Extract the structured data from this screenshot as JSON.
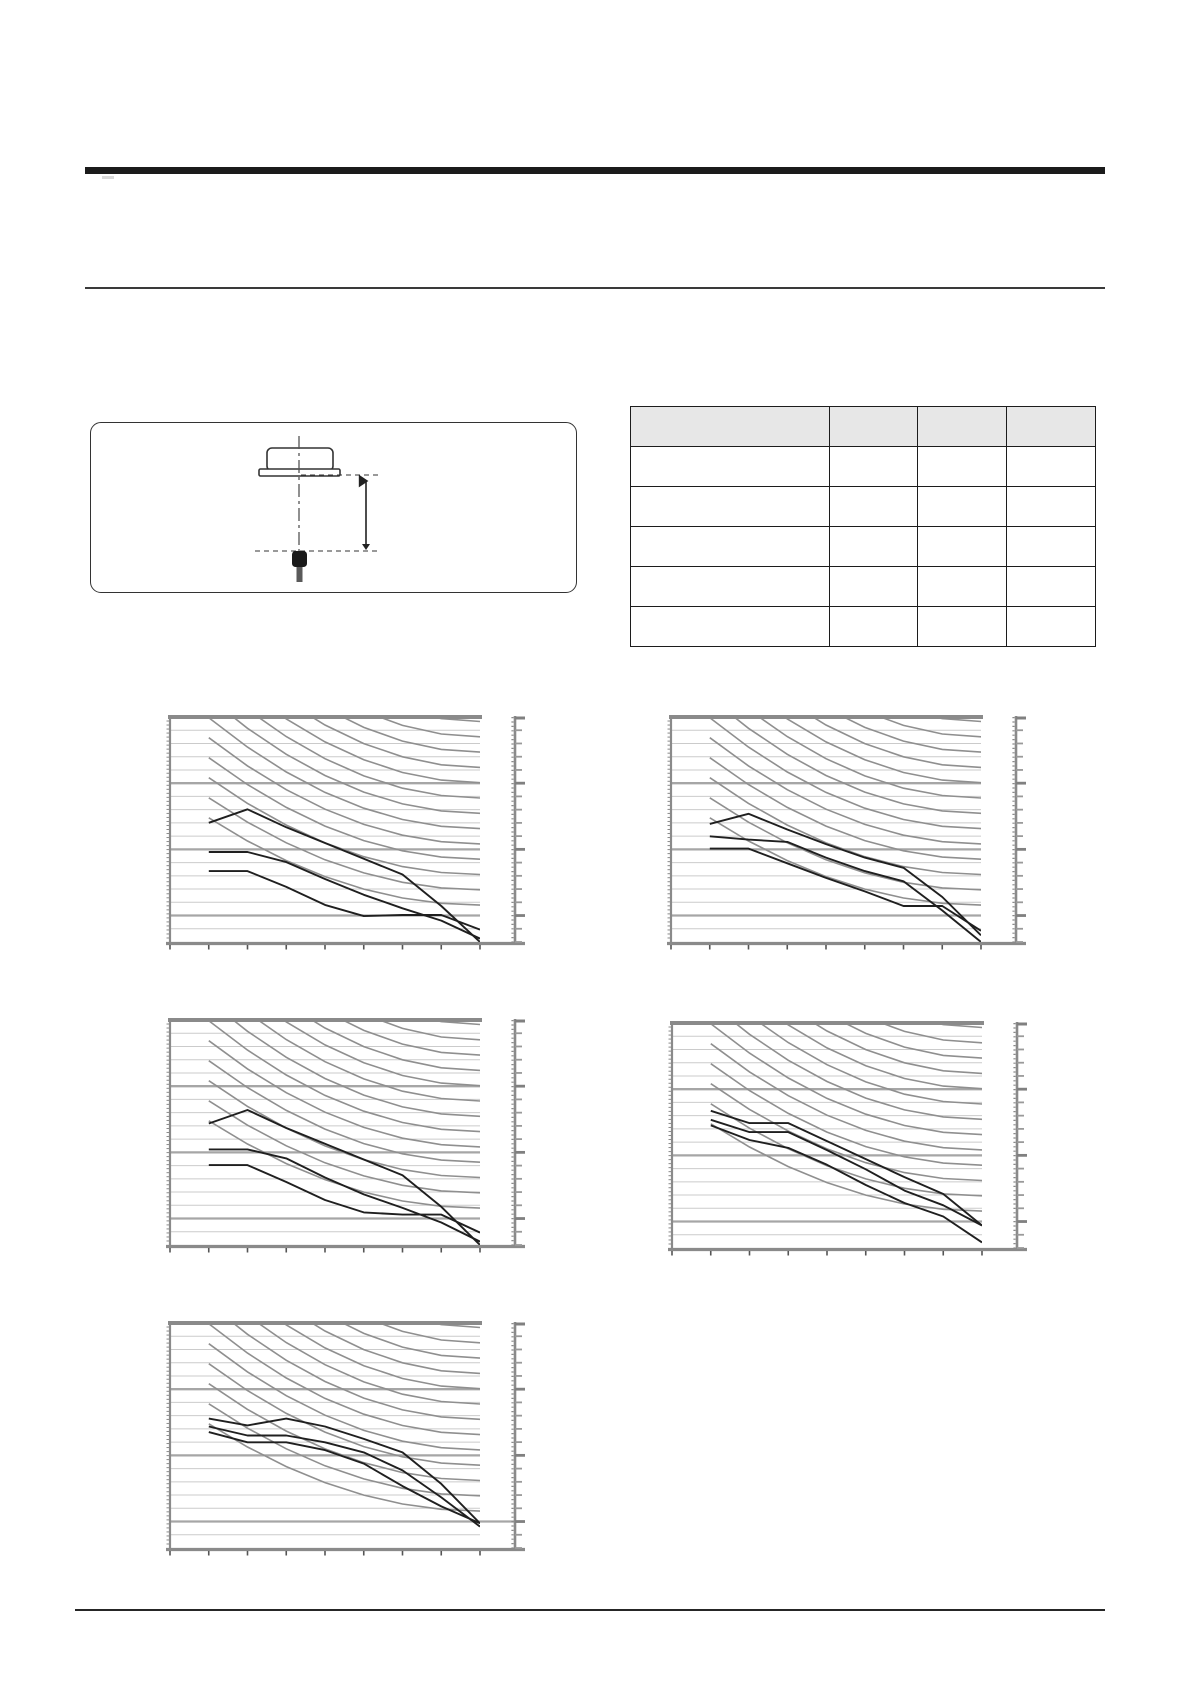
{
  "page": {
    "background": "#ffffff"
  },
  "header": {
    "thick_rule": true,
    "thin_rule": true,
    "visible_text": ""
  },
  "figure_panel": {
    "content": "ceiling-cassette-unit-with-microphone-distance-diagram",
    "elements": [
      "indoor-unit-outline",
      "center-dash-dot-line",
      "upper-dashed-line",
      "lower-dashed-line",
      "vertical-dimension-arrow",
      "microphone-symbol"
    ],
    "visible_text": ""
  },
  "table": {
    "header": [
      "",
      "",
      "",
      ""
    ],
    "rows": [
      [
        "",
        "",
        "",
        ""
      ],
      [
        "",
        "",
        "",
        ""
      ],
      [
        "",
        "",
        "",
        ""
      ],
      [
        "",
        "",
        "",
        ""
      ],
      [
        "",
        "",
        "",
        ""
      ]
    ],
    "header_bg": "#e7e7e7",
    "border_color": "#1c1c1c"
  },
  "chart_style": {
    "frame": "#8a8a8a",
    "grid_minor": "#cbcbcb",
    "grid_major": "#a6a6a6",
    "nc_curve": "#8f8f8f",
    "series_color": "#1f1f1f",
    "ruler": "#8a8a8a",
    "ruler_tick_minor": "#9a9a9a",
    "ruler_tick_major": "#808080",
    "tick": "#555555"
  },
  "chart_data": [
    {
      "id": "noise-chart-top-left",
      "type": "line",
      "x_band_count": 8,
      "x_tick_count": 9,
      "y_gridline_count": 16,
      "major_gridline_every": 5,
      "nc_reference_curves": {
        "count": 13,
        "start_frac_first": -0.62,
        "start_frac_step": 0.089,
        "end_frac_first": 0.02,
        "end_frac_step": 0.068,
        "shape_exponent": 2.0
      },
      "series": [
        {
          "name": "line-1",
          "y_frac": [
            0.47,
            0.41,
            0.49,
            0.56,
            0.63,
            0.7,
            0.84,
            1.0
          ]
        },
        {
          "name": "line-2",
          "y_frac": [
            0.6,
            0.6,
            0.645,
            0.72,
            0.79,
            0.85,
            0.905,
            0.985
          ]
        },
        {
          "name": "line-3",
          "y_frac": [
            0.685,
            0.685,
            0.755,
            0.835,
            0.885,
            0.88,
            0.88,
            0.945
          ]
        }
      ],
      "extend_major_gridline": false
    },
    {
      "id": "noise-chart-top-right",
      "type": "line",
      "x_band_count": 8,
      "x_tick_count": 9,
      "y_gridline_count": 16,
      "major_gridline_every": 5,
      "nc_reference_curves": {
        "count": 13,
        "start_frac_first": -0.62,
        "start_frac_step": 0.089,
        "end_frac_first": 0.02,
        "end_frac_step": 0.068,
        "shape_exponent": 2.0
      },
      "series": [
        {
          "name": "line-1",
          "y_frac": [
            0.475,
            0.43,
            0.5,
            0.565,
            0.625,
            0.67,
            0.8,
            0.97
          ]
        },
        {
          "name": "line-2",
          "y_frac": [
            0.53,
            0.545,
            0.555,
            0.625,
            0.685,
            0.73,
            0.86,
            1.0
          ]
        },
        {
          "name": "line-3",
          "y_frac": [
            0.585,
            0.585,
            0.65,
            0.715,
            0.775,
            0.84,
            0.84,
            0.95
          ]
        }
      ],
      "extend_major_gridline": false
    },
    {
      "id": "noise-chart-mid-left",
      "type": "line",
      "x_band_count": 8,
      "x_tick_count": 9,
      "y_gridline_count": 16,
      "major_gridline_every": 5,
      "nc_reference_curves": {
        "count": 13,
        "start_frac_first": -0.62,
        "start_frac_step": 0.089,
        "end_frac_first": 0.02,
        "end_frac_step": 0.068,
        "shape_exponent": 2.0
      },
      "series": [
        {
          "name": "line-1",
          "y_frac": [
            0.46,
            0.4,
            0.48,
            0.55,
            0.62,
            0.69,
            0.83,
            1.0
          ]
        },
        {
          "name": "line-2",
          "y_frac": [
            0.575,
            0.575,
            0.615,
            0.7,
            0.775,
            0.835,
            0.9,
            0.985
          ]
        },
        {
          "name": "line-3",
          "y_frac": [
            0.645,
            0.645,
            0.72,
            0.8,
            0.855,
            0.865,
            0.865,
            0.945
          ]
        }
      ],
      "extend_major_gridline": false
    },
    {
      "id": "noise-chart-mid-right",
      "type": "line",
      "x_band_count": 8,
      "x_tick_count": 9,
      "y_gridline_count": 16,
      "major_gridline_every": 5,
      "nc_reference_curves": {
        "count": 13,
        "start_frac_first": -0.62,
        "start_frac_step": 0.089,
        "end_frac_first": 0.02,
        "end_frac_step": 0.068,
        "shape_exponent": 2.0
      },
      "series": [
        {
          "name": "line-1",
          "y_frac": [
            0.39,
            0.445,
            0.445,
            0.525,
            0.605,
            0.685,
            0.76,
            0.9
          ]
        },
        {
          "name": "line-2",
          "y_frac": [
            0.43,
            0.485,
            0.485,
            0.565,
            0.65,
            0.745,
            0.81,
            0.9
          ]
        },
        {
          "name": "line-3",
          "y_frac": [
            0.455,
            0.52,
            0.555,
            0.63,
            0.72,
            0.8,
            0.86,
            0.975
          ]
        }
      ],
      "extend_major_gridline": false
    },
    {
      "id": "noise-chart-bottom-left",
      "type": "line",
      "x_band_count": 8,
      "x_tick_count": 9,
      "y_gridline_count": 16,
      "major_gridline_every": 5,
      "nc_reference_curves": {
        "count": 13,
        "start_frac_first": -0.62,
        "start_frac_step": 0.089,
        "end_frac_first": 0.02,
        "end_frac_step": 0.068,
        "shape_exponent": 2.0
      },
      "series": [
        {
          "name": "line-1",
          "y_frac": [
            0.425,
            0.455,
            0.425,
            0.46,
            0.515,
            0.575,
            0.715,
            0.89
          ]
        },
        {
          "name": "line-2",
          "y_frac": [
            0.46,
            0.5,
            0.5,
            0.53,
            0.575,
            0.655,
            0.775,
            0.905
          ]
        },
        {
          "name": "line-3",
          "y_frac": [
            0.485,
            0.53,
            0.53,
            0.565,
            0.625,
            0.725,
            0.815,
            0.89
          ]
        }
      ],
      "extend_major_gridline": true
    }
  ],
  "footer": {
    "rule": true,
    "visible_text": ""
  }
}
